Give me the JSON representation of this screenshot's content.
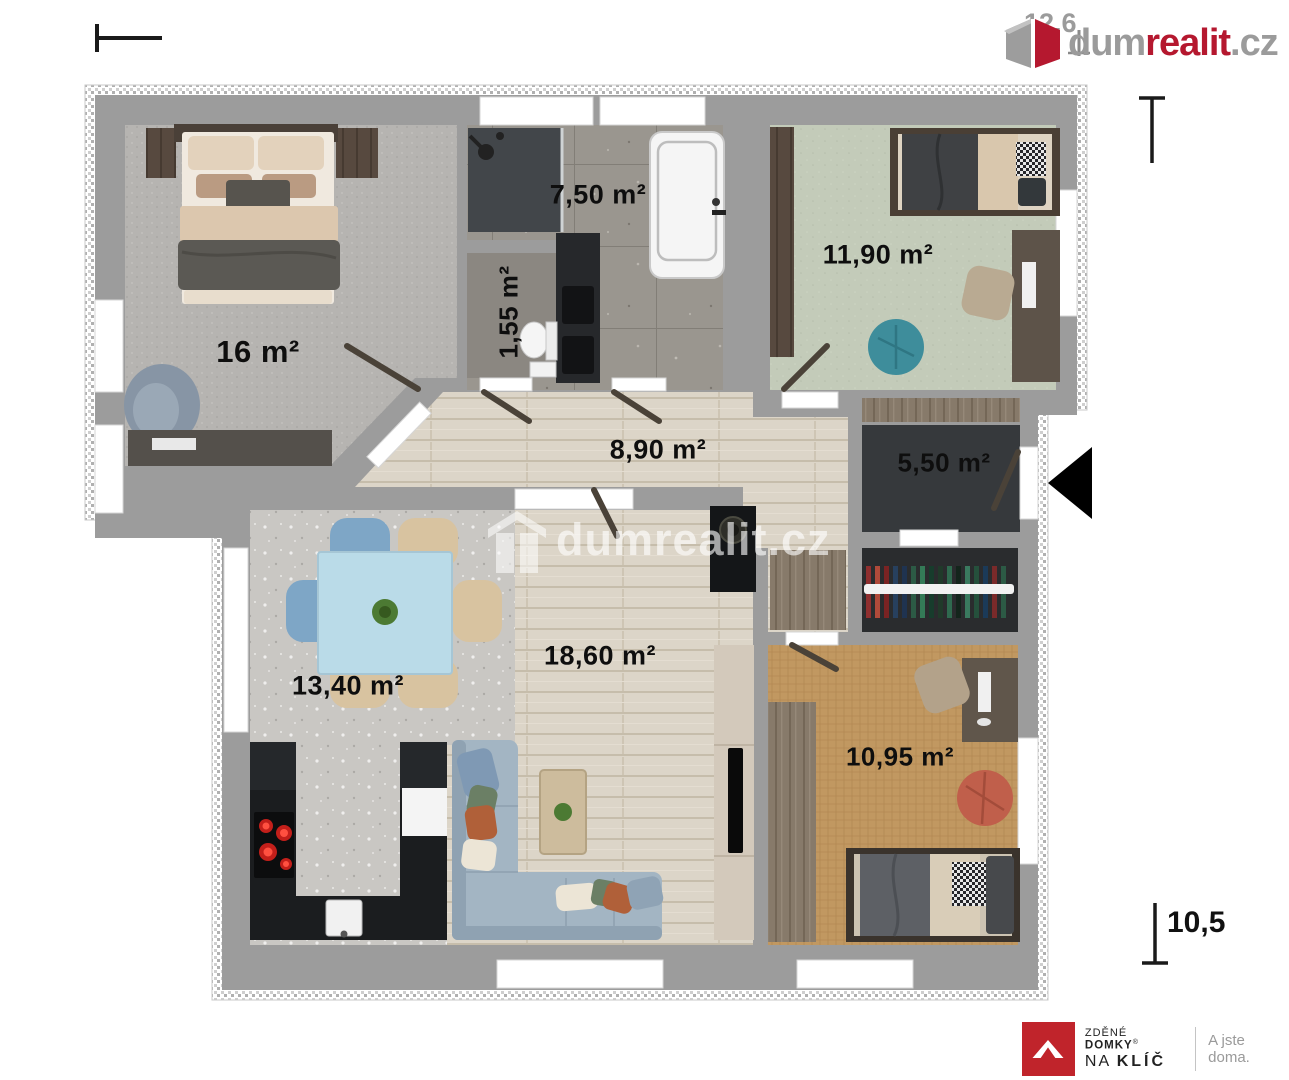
{
  "branding": {
    "logo": {
      "part_gray1": "dum",
      "part_red": "realit",
      "part_gray2": ".cz"
    },
    "watermark": "dumrealit.cz",
    "footer": {
      "line1_light": "ZDĚNÉ",
      "line1_bold": "DOMKY",
      "reg_mark": "®",
      "line2_light": "NA",
      "line2_bold": "KLÍČ",
      "tagline": "A jste doma."
    }
  },
  "dimensions": {
    "width_top": "12,6",
    "height_right": "10,5"
  },
  "rooms": [
    {
      "id": "bedroom-main",
      "label": "16 m²"
    },
    {
      "id": "bathroom",
      "label": "7,50 m²"
    },
    {
      "id": "wc",
      "label": "1,55 m²"
    },
    {
      "id": "bedroom-2",
      "label": "11,90 m²"
    },
    {
      "id": "hallway",
      "label": "8,90 m²"
    },
    {
      "id": "entry",
      "label": "5,50 m²"
    },
    {
      "id": "dining",
      "label": "13,40 m²"
    },
    {
      "id": "living",
      "label": "18,60 m²"
    },
    {
      "id": "bedroom-3",
      "label": "10,95 m²"
    }
  ],
  "colors": {
    "brand_red": "#b5182f",
    "wall_gray": "#9c9c9c",
    "accent_teal": "#3e8d9b",
    "accent_terracotta": "#c05f4b",
    "entrance_arrow": "#000000"
  }
}
